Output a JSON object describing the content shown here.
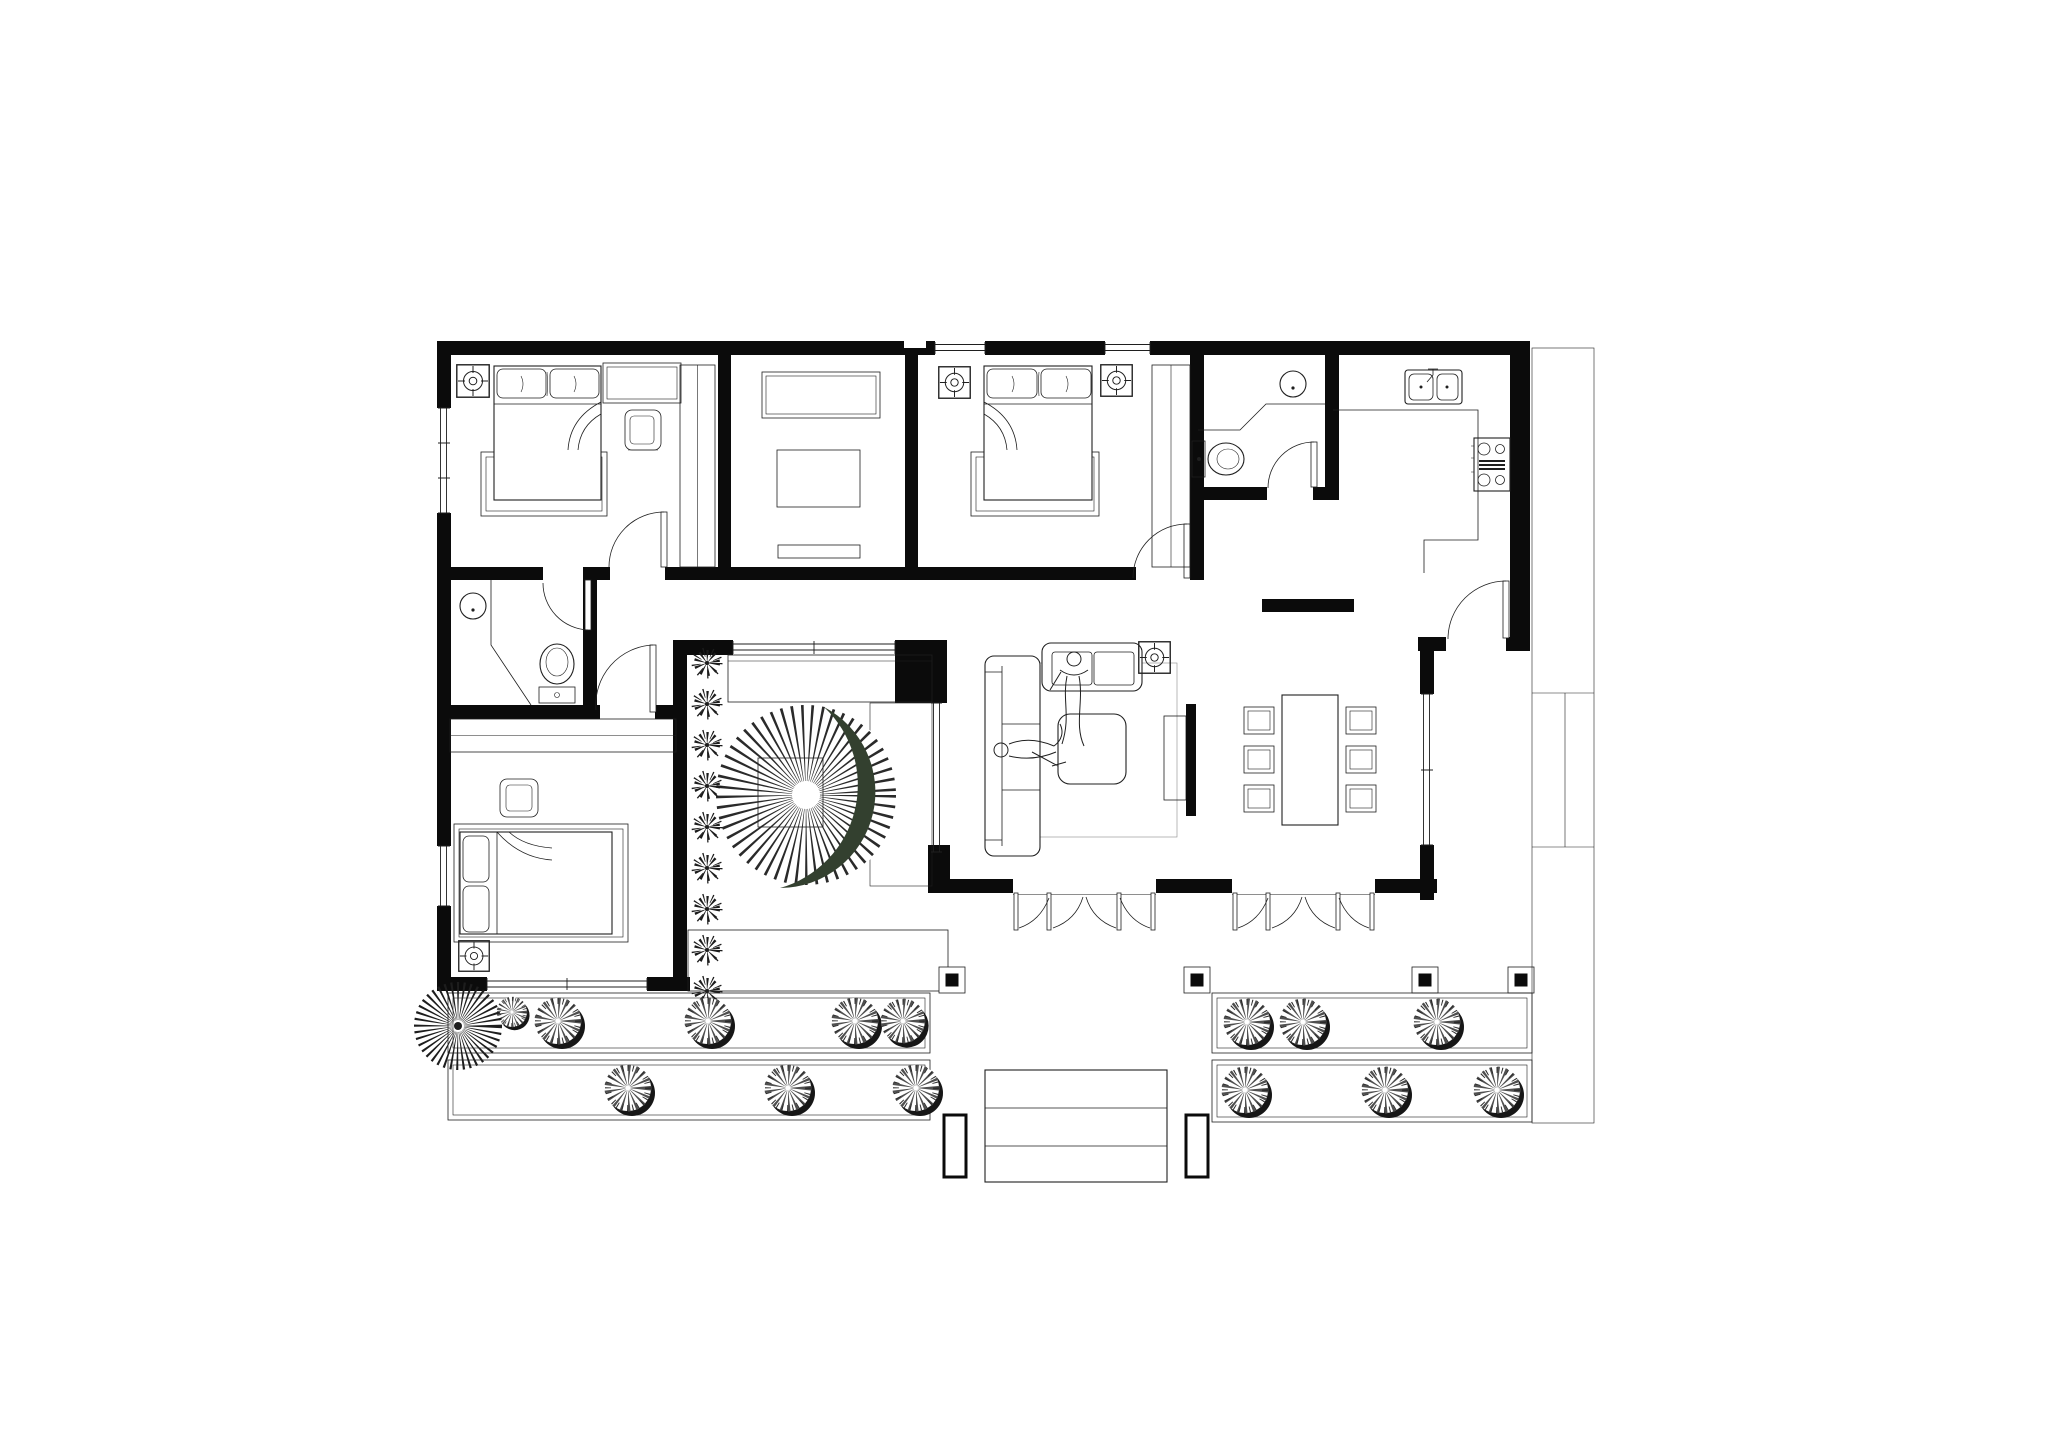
{
  "document": {
    "kind": "architectural floor plan, top view, black line work on white paper",
    "visible_text": [],
    "orientation": "landscape"
  },
  "colors": {
    "paper": "#ffffff",
    "ink": "#1f1f1f",
    "wall": "#0b0b0b",
    "muted": "#8a8a8a",
    "crescent": "#33402f",
    "shrub": "#4f4f4f",
    "shadow": "#161616",
    "stipple": "#b5b5b5",
    "deck": "#5a5a5a"
  },
  "rooms": [
    {
      "name": "bedroom-1",
      "position": "top-left",
      "items": [
        "double-bed",
        "pillow x2",
        "blanket-fold",
        "platform-frame",
        "armchair",
        "dresser",
        "closet-rail-hatch",
        "ceiling-light",
        "swing-door",
        "window-left",
        "window-top"
      ]
    },
    {
      "name": "study-room",
      "position": "top-center-left",
      "items": [
        "storage-cabinet",
        "table",
        "low-bench"
      ]
    },
    {
      "name": "bedroom-2",
      "position": "top-center",
      "items": [
        "double-bed",
        "pillow x2",
        "blanket-fold",
        "platform-frame",
        "closet-rail-hatch",
        "ceiling-light x2",
        "swing-door",
        "window-top x2"
      ]
    },
    {
      "name": "bathroom-1",
      "position": "top-right-of-bedroom-2",
      "items": [
        "round-washbasin",
        "counter-with-splay",
        "toilet",
        "swing-door"
      ]
    },
    {
      "name": "kitchen",
      "position": "top-right",
      "items": [
        "double-bowl-sink",
        "faucet",
        "l-shaped-counter",
        "cooktop-4-burner",
        "entry-swing-door",
        "freestanding-wall-segment"
      ]
    },
    {
      "name": "bathroom-2",
      "position": "middle-left",
      "items": [
        "round-washbasin",
        "corner-screen",
        "toilet",
        "swing-door"
      ]
    },
    {
      "name": "hallway",
      "position": "middle-left",
      "items": [
        "swing-door-to-bedroom-3"
      ]
    },
    {
      "name": "bedroom-3",
      "position": "bottom-left",
      "items": [
        "double-bed",
        "pillow x2",
        "armchair",
        "wardrobe-hatch-strip",
        "ceiling-light",
        "south-window",
        "left-window"
      ]
    },
    {
      "name": "courtyard",
      "position": "center",
      "items": [
        "plant-row x9",
        "deck-planks-top",
        "deck-planks-bottom",
        "stair-treads",
        "sunburst-circle",
        "crescent-inlay",
        "square-frame",
        "glass-wall-north",
        "glass-wall-east"
      ]
    },
    {
      "name": "living-room",
      "position": "center-right",
      "items": [
        "long-sofa",
        "loveseat",
        "person-sitting",
        "person-lying",
        "coffee-table",
        "area-rug",
        "tv-panel",
        "tv-cabinet",
        "ceiling-light",
        "east-window"
      ]
    },
    {
      "name": "dining-area",
      "position": "right",
      "items": [
        "dining-table",
        "dining-chair x6"
      ]
    },
    {
      "name": "porch",
      "position": "bottom-center",
      "items": [
        "folding-glass-door-set x2",
        "column x4"
      ]
    },
    {
      "name": "garden",
      "position": "bottom",
      "items": [
        "planter-strip x4",
        "shrub x14",
        "large-spiky-tree",
        "entrance-steps",
        "entrance-planter x2"
      ]
    },
    {
      "name": "side-terrace",
      "position": "right-edge",
      "items": [
        "walkway-strip",
        "divider-box"
      ]
    }
  ],
  "openings": {
    "swing_doors": 6,
    "folding_door_sets": 2,
    "folding_leaves_per_set": 4,
    "windows": [
      "top-wall-bedroom2-left",
      "top-wall-bedroom2-right",
      "left-wall-bedroom1",
      "left-wall-bedroom3",
      "bedroom3-south",
      "courtyard-north-glass",
      "courtyard-east-glass",
      "living-room-east"
    ]
  },
  "counts": {
    "ceiling_lights": 5,
    "dining_chairs": 6,
    "porch_columns": 4,
    "entrance_step_treads": 3,
    "courtyard_plants": 9,
    "garden_shrubs": 14,
    "large_trees": 1
  },
  "symbols": {
    "ceiling_light": "square with concentric circles and cross ticks",
    "door": "quarter-circle swing arc with leaf",
    "folding_door": "scalloped arc row with leaf ticks",
    "closet": "ladder hatch strip",
    "wardrobe": "dense vertical hatch strip",
    "deck": "parallel plank lines",
    "stair": "horizontal tread lines",
    "gravel": "stipple dots",
    "shrub": "radial-spike circle with dark cast shadow",
    "plant": "star burst",
    "sunburst_deck": "radial spoke circle with dark green crescent"
  }
}
